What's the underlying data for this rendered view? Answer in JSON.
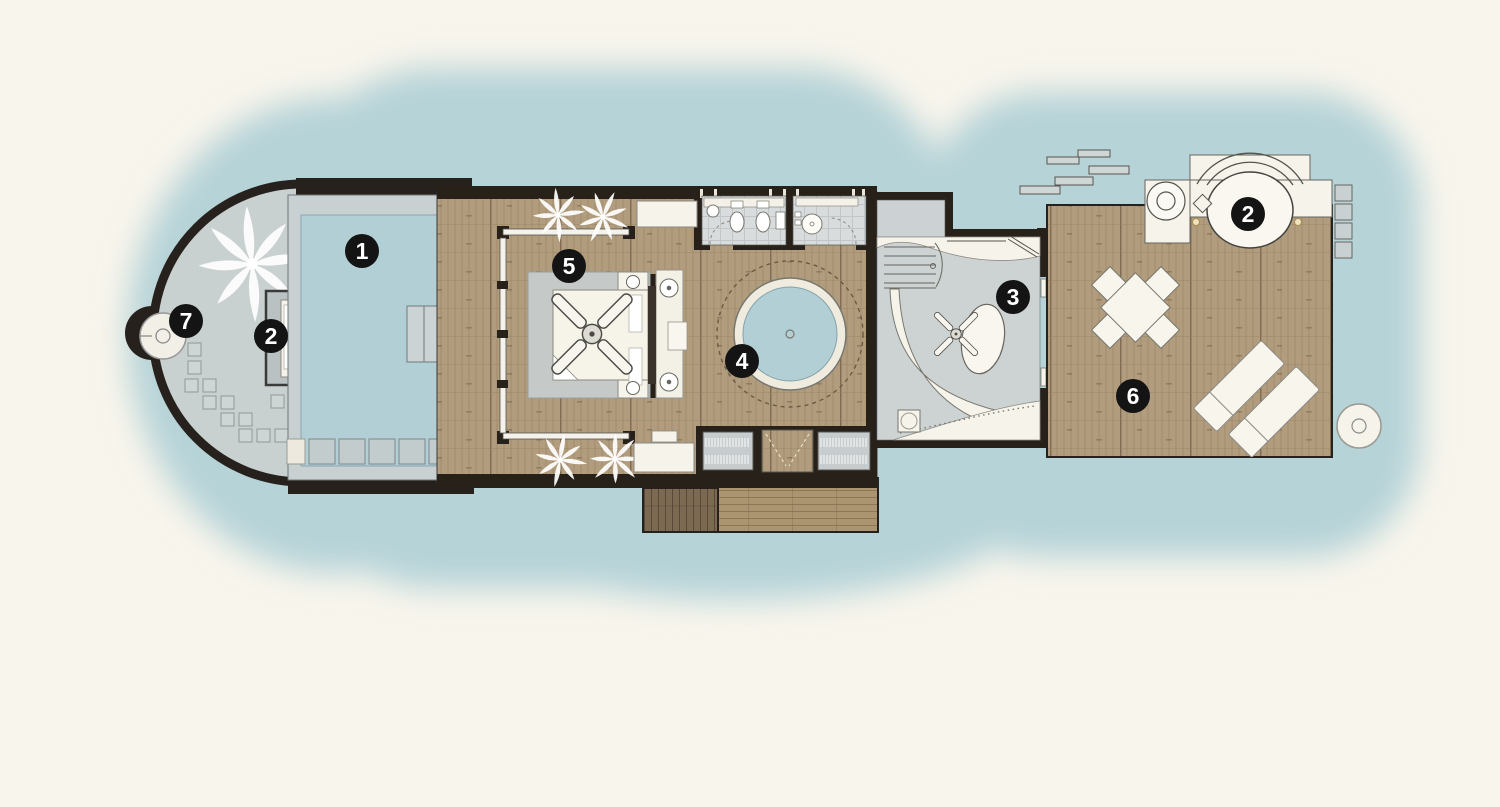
{
  "markers": {
    "pool": "1",
    "left_daybed": "2",
    "bathroom": "3",
    "jacuzzi": "4",
    "bedroom": "5",
    "sun_deck": "6",
    "outdoor_shower": "7",
    "right_daybed": "2"
  },
  "colors": {
    "background": "#f8f5ec",
    "water": "#b6d3d8",
    "pool_water": "#b3cfd6",
    "wood_deck": "#b29c7e",
    "dark_wood": "#7c6951",
    "walls": "#272119",
    "stone_deck": "#c9d0d0",
    "tile_floor": "#d8dcdc",
    "furniture_white": "#f6f3ea",
    "marker_background": "#141414",
    "marker_text": "#ffffff"
  }
}
